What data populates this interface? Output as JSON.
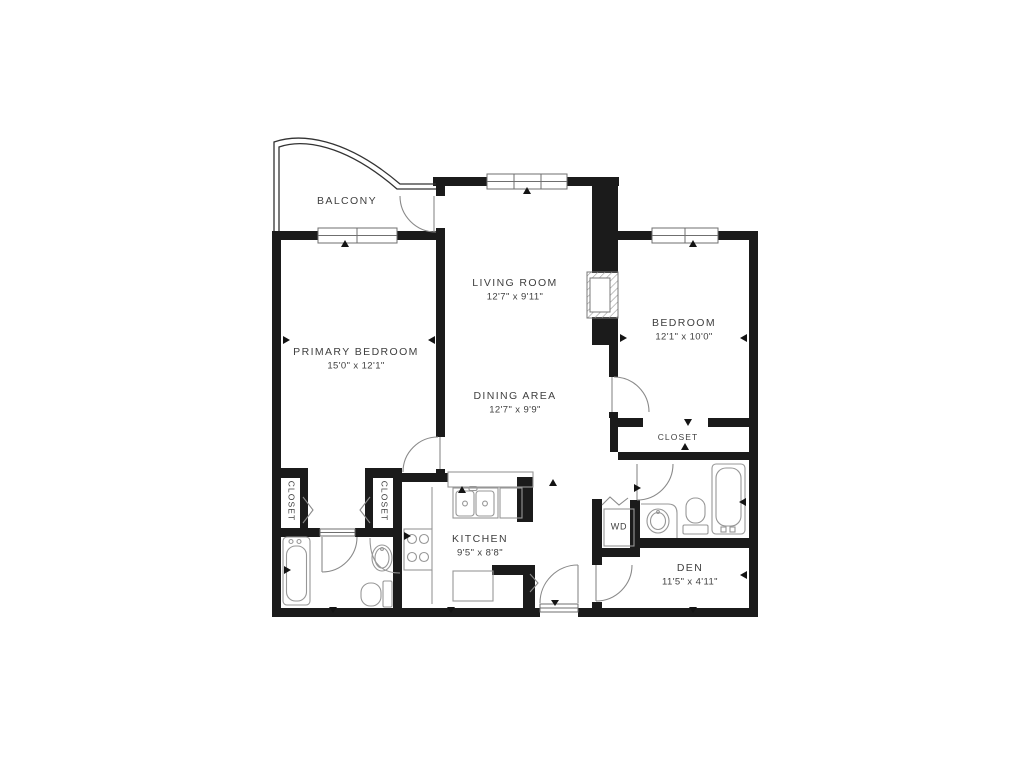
{
  "meta": {
    "colors": {
      "background": "#ffffff",
      "wall": "#1b1b1b",
      "fixture_line": "#979797",
      "door_line": "#8a8a8a",
      "text": "#3f3f3f"
    }
  },
  "rooms": {
    "balcony": {
      "label": "BALCONY"
    },
    "living_room": {
      "label": "LIVING ROOM",
      "dimensions": "12'7\" x 9'11\""
    },
    "dining_area": {
      "label": "DINING AREA",
      "dimensions": "12'7\" x 9'9\""
    },
    "primary_bedroom": {
      "label": "PRIMARY BEDROOM",
      "dimensions": "15'0\" x 12'1\""
    },
    "bedroom": {
      "label": "BEDROOM",
      "dimensions": "12'1\" x 10'0\""
    },
    "kitchen": {
      "label": "KITCHEN",
      "dimensions": "9'5\" x 8'8\""
    },
    "den": {
      "label": "DEN",
      "dimensions": "11'5\" x 4'11\""
    },
    "bedroom_closet": {
      "label": "CLOSET"
    },
    "hall_closet_left": {
      "label": "CLOSET"
    },
    "hall_closet_right": {
      "label": "CLOSET"
    },
    "washer_dryer": {
      "label": "WD"
    }
  }
}
